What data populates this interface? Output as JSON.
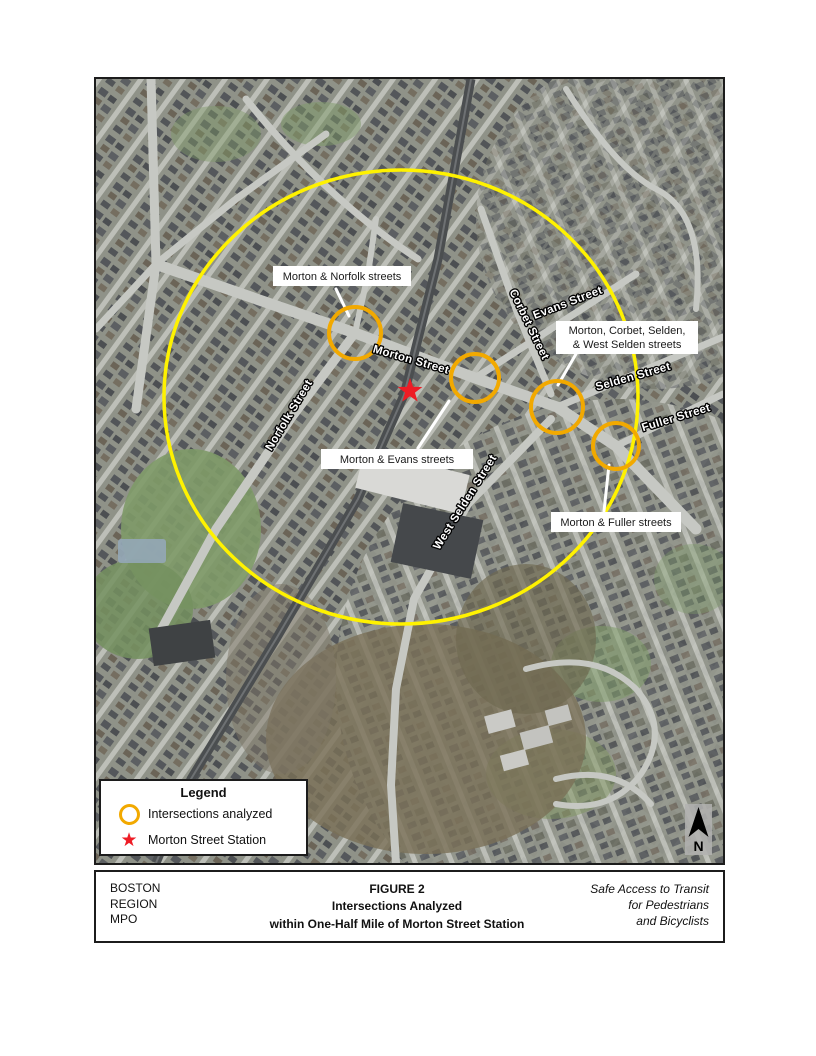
{
  "figure": {
    "caption": {
      "org": [
        "BOSTON",
        "REGION",
        "MPO"
      ],
      "title": [
        "FIGURE 2",
        "Intersections Analyzed",
        "within One-Half Mile of Morton Street Station"
      ],
      "project": [
        "Safe Access to Transit",
        "for Pedestrians",
        "and Bicyclists"
      ]
    }
  },
  "legend": {
    "title": "Legend",
    "items": [
      {
        "icon": "orange-ring-icon",
        "label": "Intersections analyzed"
      },
      {
        "icon": "red-star-icon",
        "label": "Morton Street Station"
      }
    ]
  },
  "map": {
    "north_label": "N",
    "street_labels": {
      "norfolk": "Norfolk Street",
      "morton": "Morton Street",
      "corbet": "Corbet Street",
      "evans": "Evans Street",
      "selden": "Selden Street",
      "fuller": "Fuller Street",
      "west_selden": "West Selden Street"
    },
    "callouts": {
      "morton_norfolk": "Morton & Norfolk streets",
      "morton_corbet_line1": "Morton, Corbet, Selden,",
      "morton_corbet_line2": "& West Selden streets",
      "morton_evans": "Morton & Evans streets",
      "morton_fuller": "Morton & Fuller streets"
    }
  },
  "colors": {
    "radius_yellow": "#FFF200",
    "intersection_orange": "#F2A900",
    "station_red": "#EE1C25"
  }
}
